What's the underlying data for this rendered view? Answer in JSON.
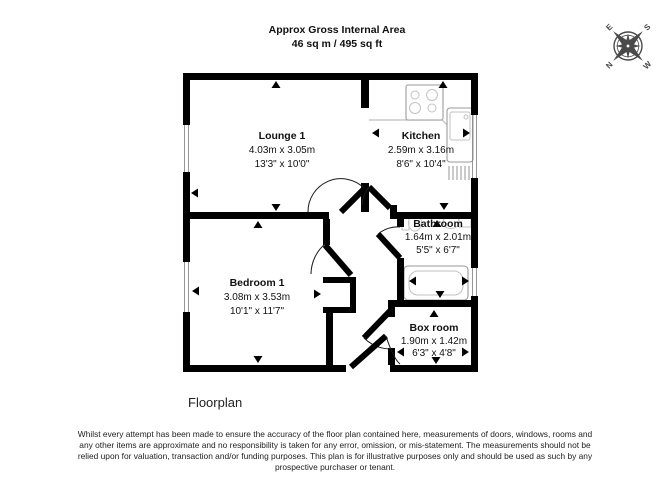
{
  "title": {
    "line1": "Approx Gross Internal Area",
    "line2": "46 sq m / 495 sq ft"
  },
  "compass": {
    "n": "N",
    "e": "E",
    "s": "S",
    "w": "W"
  },
  "rooms": [
    {
      "name": "Lounge 1",
      "metric": "4.03m x 3.05m",
      "imperial": "13'3\" x 10'0\""
    },
    {
      "name": "Kitchen",
      "metric": "2.59m x 3.16m",
      "imperial": "8'6\" x 10'4\""
    },
    {
      "name": "Bathroom",
      "metric": "1.64m x 2.01m",
      "imperial": "5'5\" x 6'7\""
    },
    {
      "name": "Bedroom 1",
      "metric": "3.08m x 3.53m",
      "imperial": "10'1\" x 11'7\""
    },
    {
      "name": "Box room",
      "metric": "1.90m x 1.42m",
      "imperial": "6'3\" x 4'8\""
    }
  ],
  "caption": "Floorplan",
  "disclaimer": {
    "lines": [
      "Whilst every attempt has been made to ensure the accuracy of the floor plan contained here, measurements of doors, windows, rooms and",
      "any other items are approximate and no responsibility is taken for any error, omission, or mis-statement. The measurements should not be",
      "relied upon for valuation, transaction and/or funding purposes. This plan is for illustrative purposes only and should be used as such by any",
      "prospective purchaser or tenant."
    ]
  },
  "colors": {
    "wall": "#000000",
    "fixture_outline": "#9a9a9a",
    "compass": "#4a4a4a",
    "text": "#111111"
  }
}
